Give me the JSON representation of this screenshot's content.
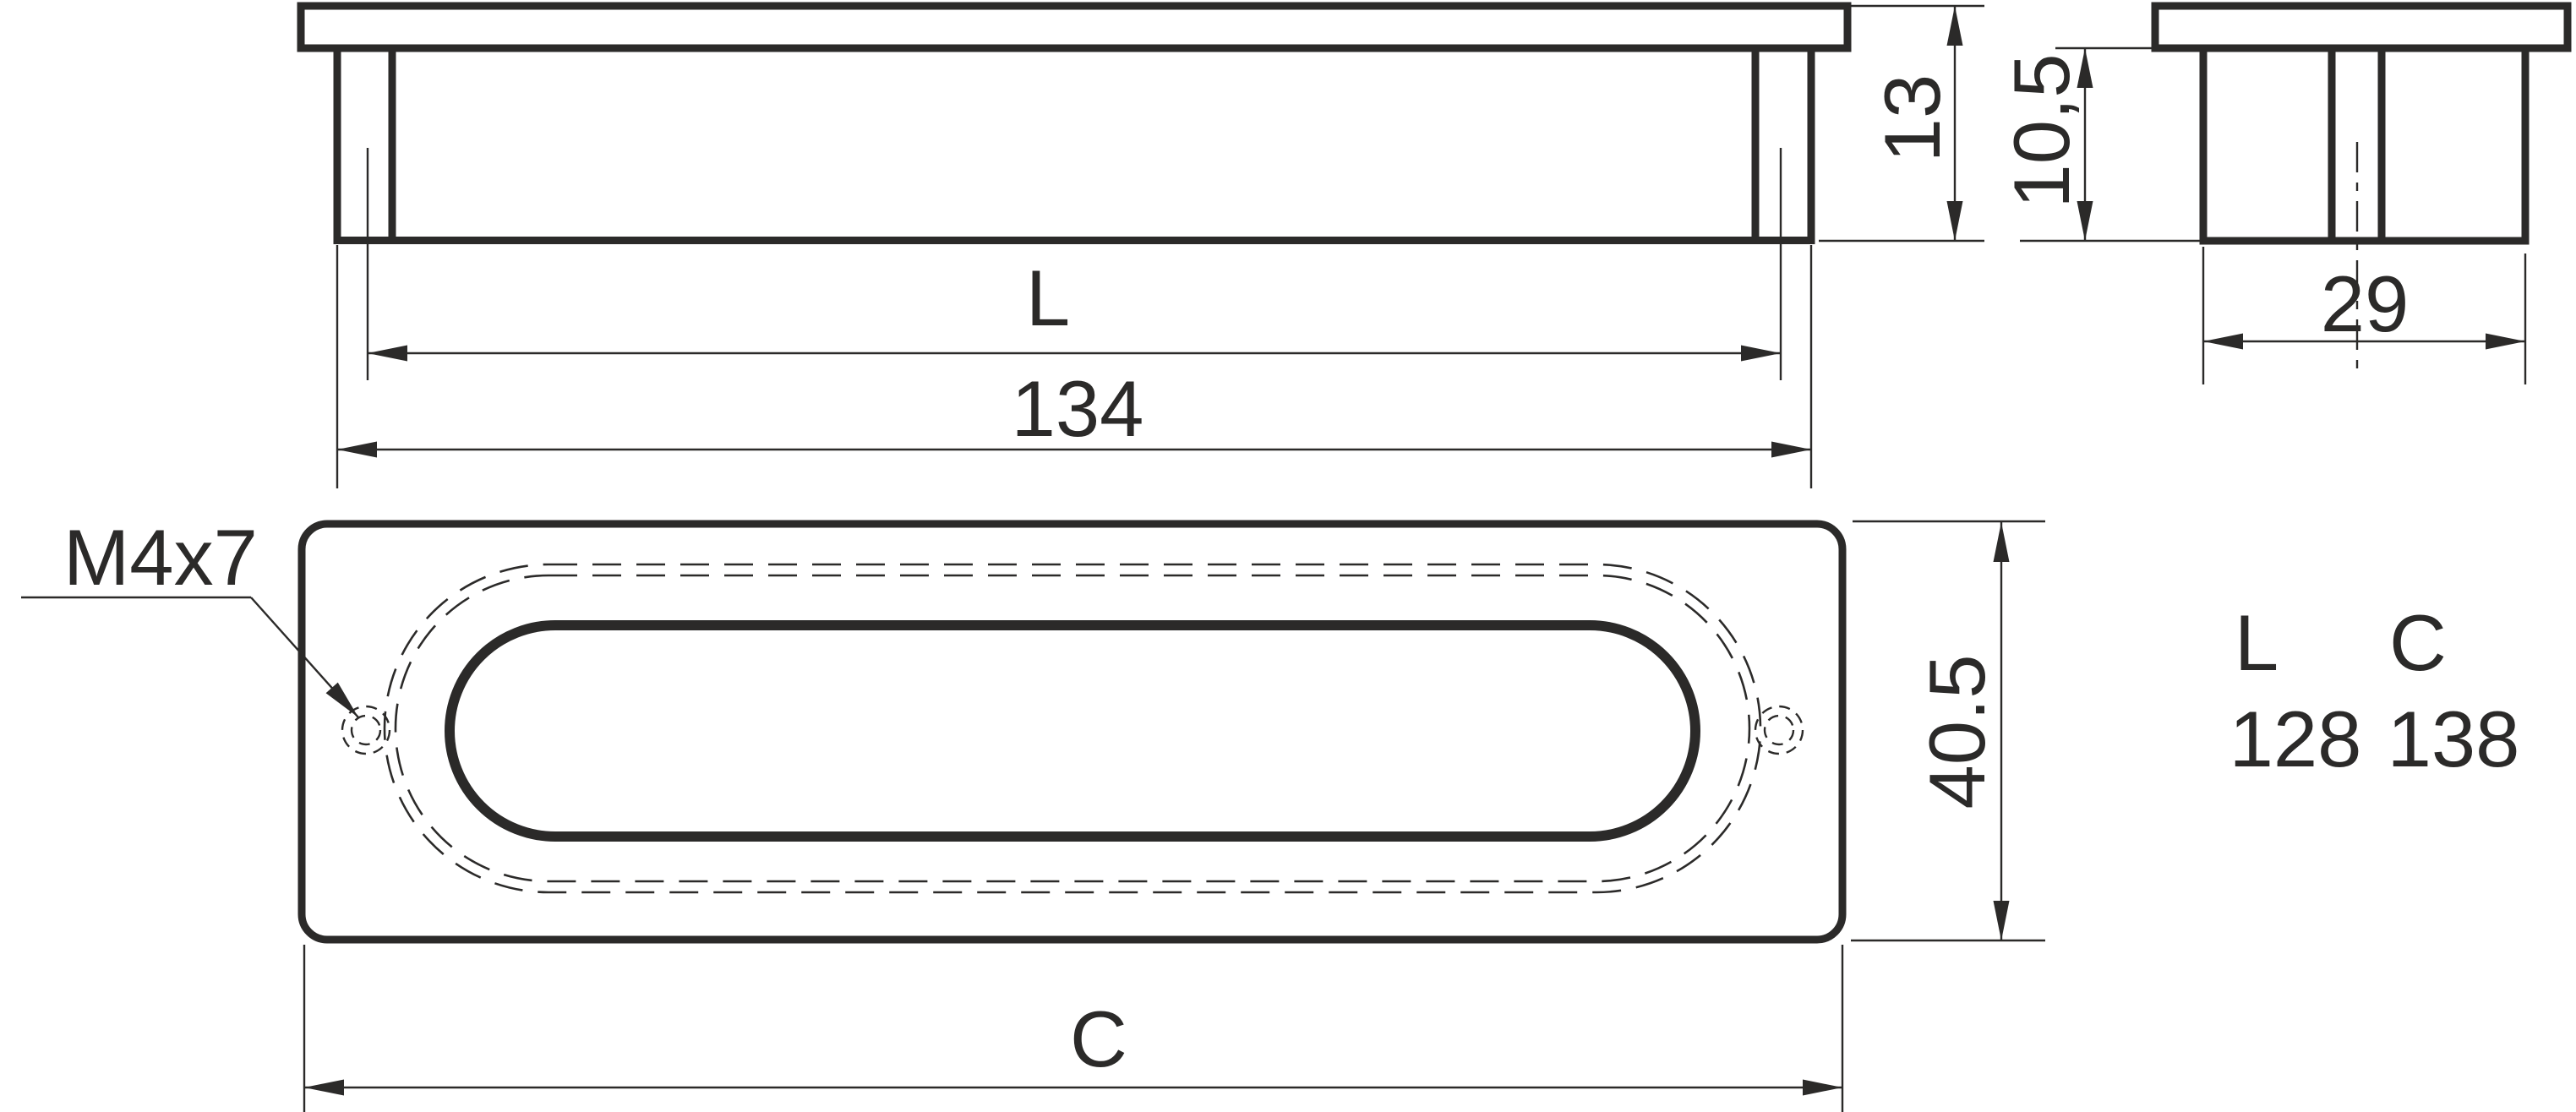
{
  "drawing": {
    "front_view": {
      "dim_centers_label": "L",
      "dim_overall_length": "134",
      "dim_total_height": "13"
    },
    "side_view": {
      "dim_body_height": "10,5",
      "dim_width": "29"
    },
    "plan_view": {
      "thread_callout": "M4x7",
      "dim_plate_height": "40.5",
      "dim_plate_length_label": "C"
    },
    "size_table": {
      "col1_header": "L",
      "col2_header": "C",
      "col1_value": "128",
      "col2_value": "138"
    }
  },
  "colors": {
    "ink": "#2b2a29",
    "background": "#ffffff"
  }
}
